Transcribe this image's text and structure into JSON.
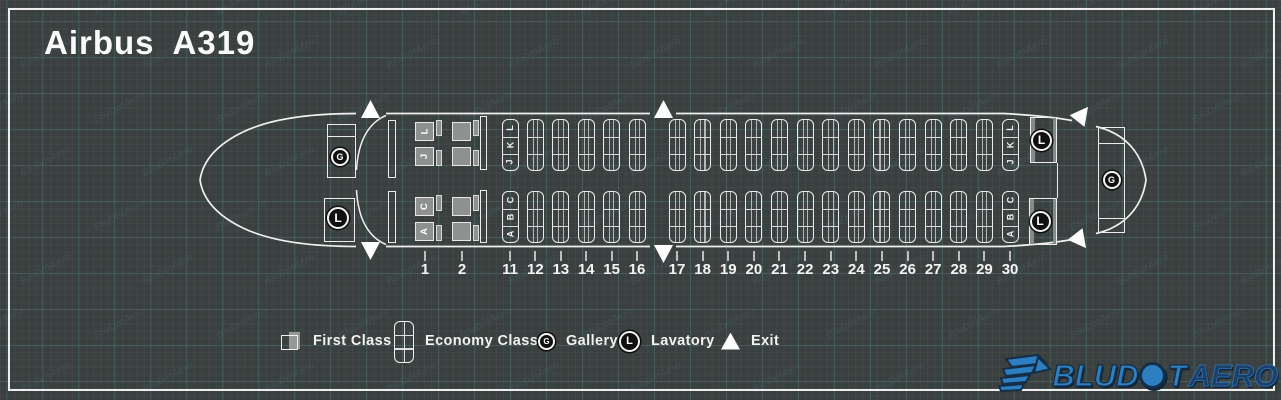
{
  "title": "Airbus A319",
  "watermark": "BluDotAero",
  "colors": {
    "background": "#3a403f",
    "outline": "#f0f0f0",
    "seat_gray": "#8f9191",
    "facility_circle": "#101010",
    "logo_blue": "#2e7fc2",
    "logo_navy": "#1c3f66"
  },
  "seatmap": {
    "first_class_letters": {
      "top": [
        "L",
        "J"
      ],
      "bottom": [
        "C",
        "A"
      ]
    },
    "economy_letters": {
      "top": [
        "L",
        "K",
        "J"
      ],
      "bottom": [
        "C",
        "B",
        "A"
      ]
    },
    "rows": [
      {
        "number": "1",
        "cabin": "first",
        "lettered": true
      },
      {
        "number": "2",
        "cabin": "first",
        "lettered": false
      },
      {
        "number": "11",
        "cabin": "economy",
        "lettered": true
      },
      {
        "number": "12",
        "cabin": "economy",
        "lettered": false
      },
      {
        "number": "13",
        "cabin": "economy",
        "lettered": false
      },
      {
        "number": "14",
        "cabin": "economy",
        "lettered": false
      },
      {
        "number": "15",
        "cabin": "economy",
        "lettered": false
      },
      {
        "number": "16",
        "cabin": "economy",
        "lettered": false
      },
      {
        "number": "17",
        "cabin": "economy",
        "lettered": false
      },
      {
        "number": "18",
        "cabin": "economy",
        "lettered": false
      },
      {
        "number": "19",
        "cabin": "economy",
        "lettered": false
      },
      {
        "number": "20",
        "cabin": "economy",
        "lettered": false
      },
      {
        "number": "21",
        "cabin": "economy",
        "lettered": false
      },
      {
        "number": "22",
        "cabin": "economy",
        "lettered": false
      },
      {
        "number": "23",
        "cabin": "economy",
        "lettered": false
      },
      {
        "number": "24",
        "cabin": "economy",
        "lettered": false
      },
      {
        "number": "25",
        "cabin": "economy",
        "lettered": false
      },
      {
        "number": "26",
        "cabin": "economy",
        "lettered": false
      },
      {
        "number": "27",
        "cabin": "economy",
        "lettered": false
      },
      {
        "number": "28",
        "cabin": "economy",
        "lettered": false
      },
      {
        "number": "29",
        "cabin": "economy",
        "lettered": false
      },
      {
        "number": "30",
        "cabin": "economy",
        "lettered": true
      }
    ],
    "facilities": [
      {
        "id": "front-galley",
        "symbol": "G"
      },
      {
        "id": "front-lavatory",
        "symbol": "L"
      },
      {
        "id": "rear-lavatory-top",
        "symbol": "L"
      },
      {
        "id": "rear-lavatory-bottom",
        "symbol": "L"
      },
      {
        "id": "rear-galley",
        "symbol": "G"
      }
    ]
  },
  "legend": [
    {
      "id": "first-class",
      "label": "First Class"
    },
    {
      "id": "economy-class",
      "label": "Economy Class"
    },
    {
      "id": "gallery",
      "label": "Gallery",
      "symbol": "G"
    },
    {
      "id": "lavatory",
      "label": "Lavatory",
      "symbol": "L"
    },
    {
      "id": "exit",
      "label": "Exit"
    }
  ],
  "logo": {
    "blu": "BLU",
    "d": "D",
    "t": "T",
    "aero": "AERO"
  }
}
